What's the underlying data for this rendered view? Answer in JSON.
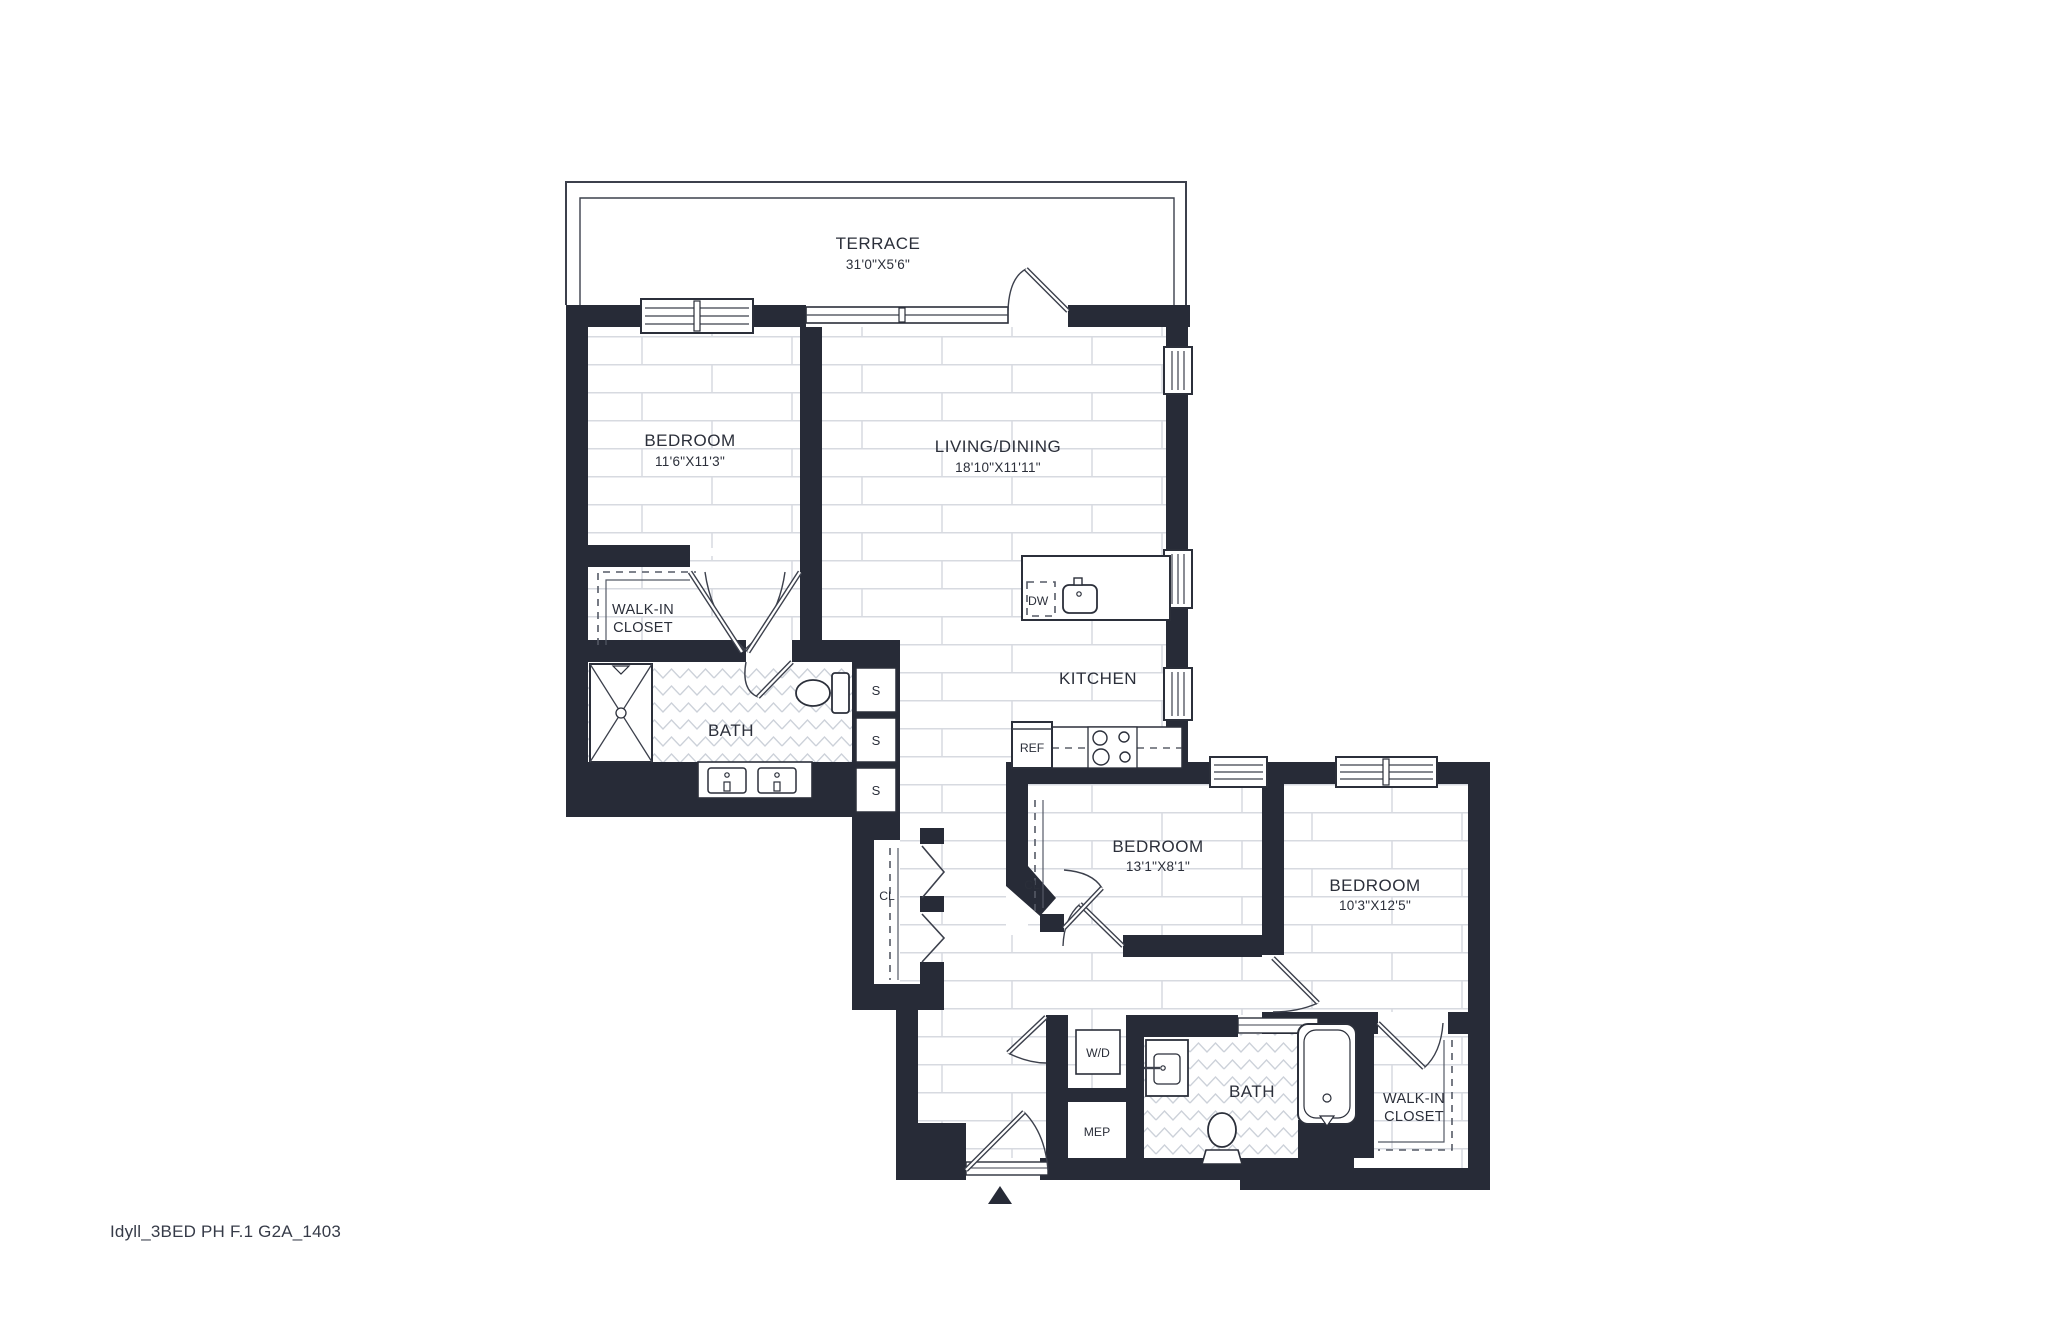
{
  "colors": {
    "wall": "#272b37",
    "line": "#3c404c",
    "floor_line": "#d7dae0",
    "accent_text": "#2b2f3a"
  },
  "rooms": {
    "terrace": {
      "name": "TERRACE",
      "dims": "31'0\"X5'6\""
    },
    "bedroom1": {
      "name": "BEDROOM",
      "dims": "11'6\"X11'3\""
    },
    "living": {
      "name": "LIVING/DINING",
      "dims": "18'10\"X11'11\""
    },
    "walkin1": {
      "line1": "WALK-IN",
      "line2": "CLOSET"
    },
    "bath1": {
      "name": "BATH"
    },
    "kitchen": {
      "name": "KITCHEN"
    },
    "bedroom2": {
      "name": "BEDROOM",
      "dims": "13'1\"X8'1\""
    },
    "bedroom3": {
      "name": "BEDROOM",
      "dims": "10'3\"X12'5\""
    },
    "bath2": {
      "name": "BATH"
    },
    "walkin2": {
      "line1": "WALK-IN",
      "line2": "CLOSET"
    }
  },
  "fixtures": {
    "dishwasher": "DW",
    "refrigerator": "REF",
    "washer_dryer": "W/D",
    "mep": "MEP",
    "shelf": "S",
    "closet1": "CL",
    "closet2": "CL"
  },
  "footer": {
    "label": "Idyll_3BED PH F.1 G2A_1403"
  }
}
